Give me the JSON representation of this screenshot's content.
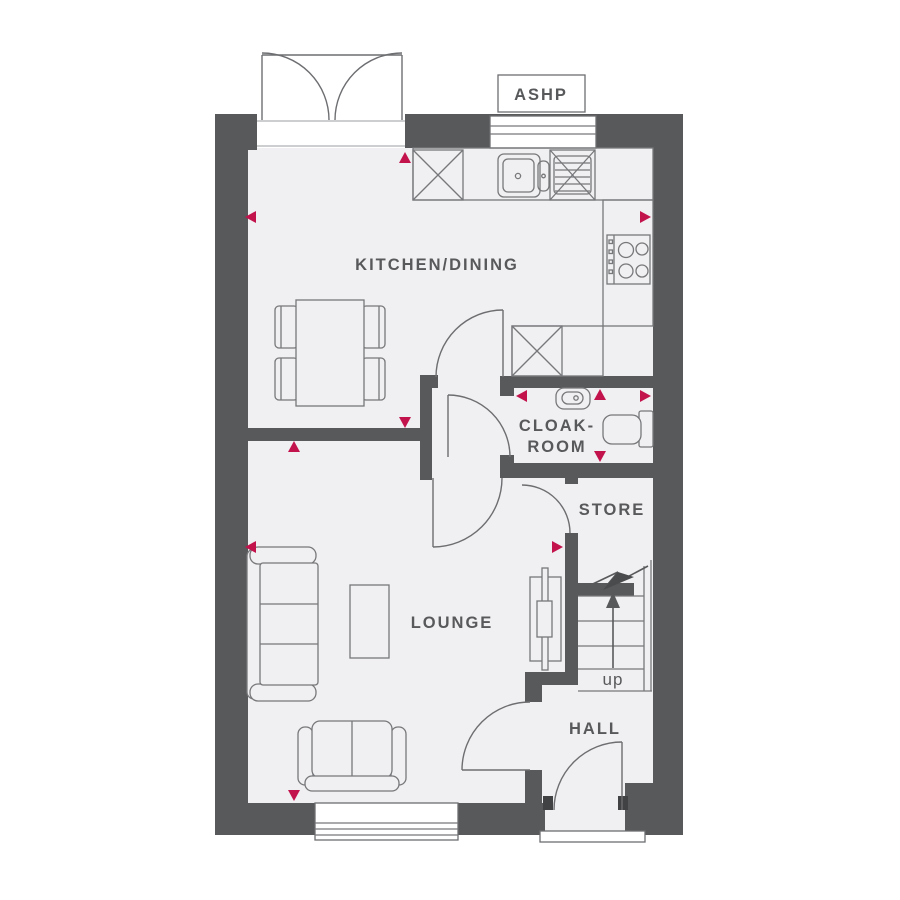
{
  "plan": {
    "type": "ground-floor-plan",
    "labels": {
      "ashp": "ASHP",
      "kitchen_dining": "KITCHEN/DINING",
      "cloakroom_line1": "CLOAK-",
      "cloakroom_line2": "ROOM",
      "store": "STORE",
      "lounge": "LOUNGE",
      "hall": "HALL",
      "stairs_direction": "up"
    },
    "rooms": [
      "KITCHEN/DINING",
      "CLOAK-ROOM",
      "STORE",
      "LOUNGE",
      "HALL"
    ],
    "colors": {
      "wall": "#58595B",
      "floor": "#F0EFF1",
      "outline": "#6D6E71",
      "furniture_outline": "#77787B",
      "dimension_marker": "#C3134D",
      "background": "#FFFFFF",
      "label_text": "#58595B"
    }
  }
}
